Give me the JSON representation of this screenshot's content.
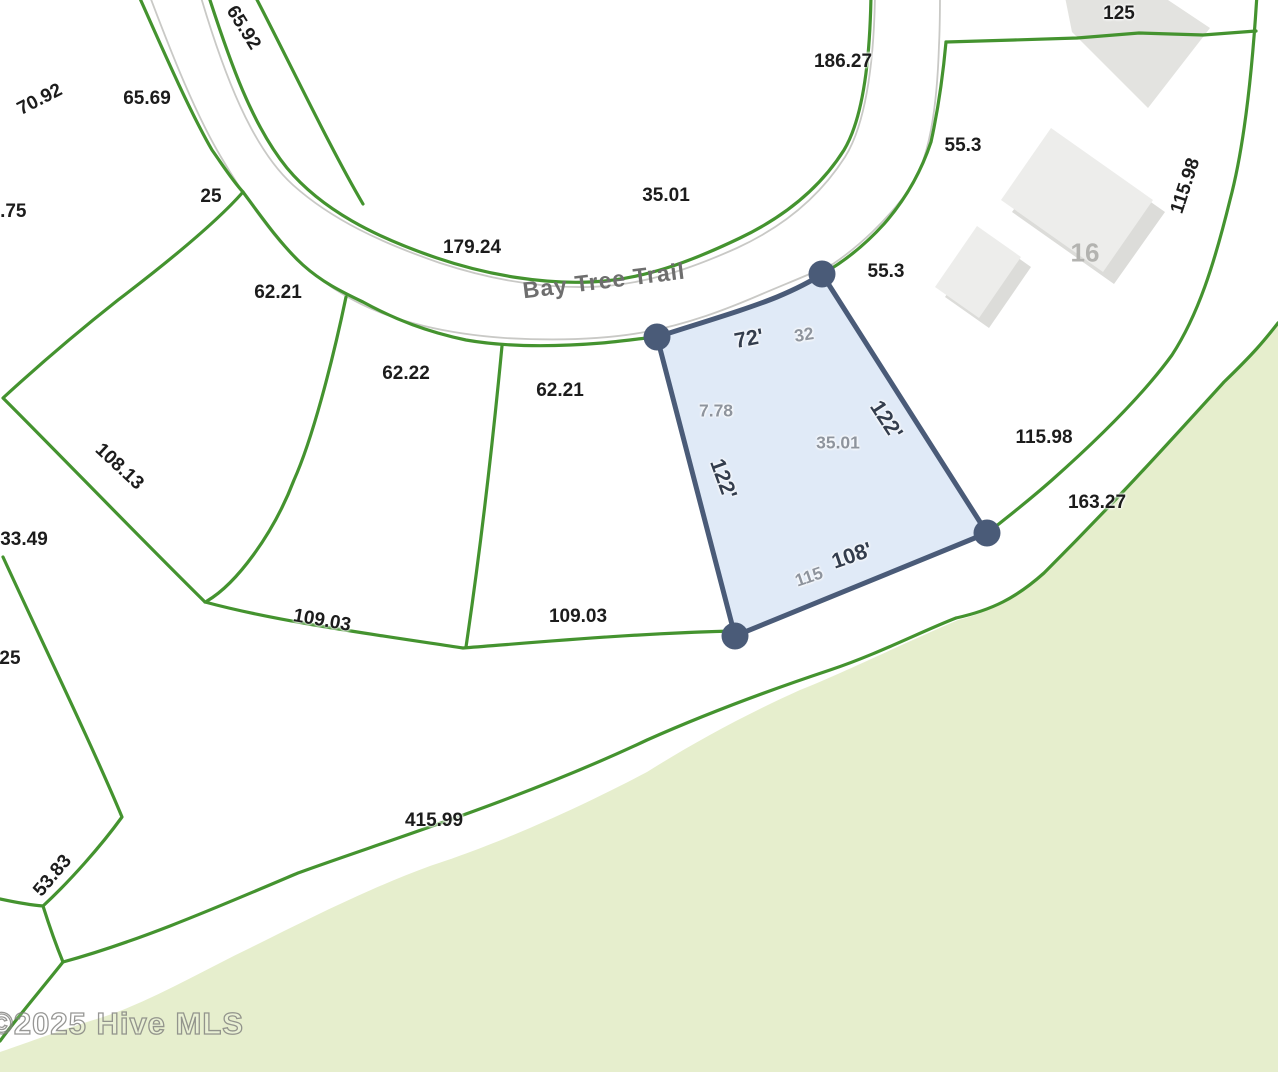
{
  "map": {
    "street_name": "Bay Tree Trail",
    "watermark": "©2025 Hive MLS",
    "highlighted_lot": {
      "lot_number": "32",
      "frontage": "72'",
      "left_side": "122'",
      "right_side": "122'",
      "rear": "108'",
      "gray_values": [
        "7.78",
        "35.01",
        "115"
      ]
    },
    "building_parcel_number": "16",
    "colors": {
      "parcel_line_green": "#44932f",
      "road_casing_gray": "#c9c9c6",
      "conservation_green": "#e6eecd",
      "lot_fill_blue": "#d9e5f5",
      "lot_border_slate": "#4a5b78",
      "building_gray": "#ececea"
    },
    "labels": [
      {
        "text": "65.92",
        "x": 243,
        "y": 28,
        "rot": 58,
        "kind": "black"
      },
      {
        "text": "70.92",
        "x": 40,
        "y": 100,
        "rot": -27,
        "kind": "black"
      },
      {
        "text": "65.69",
        "x": 147,
        "y": 99,
        "rot": 0,
        "kind": "black"
      },
      {
        "text": "1.75",
        "x": 8,
        "y": 212,
        "rot": 0,
        "kind": "black"
      },
      {
        "text": "25",
        "x": 211,
        "y": 197,
        "rot": 0,
        "kind": "black"
      },
      {
        "text": "186.27",
        "x": 843,
        "y": 62,
        "rot": 0,
        "kind": "black"
      },
      {
        "text": "125",
        "x": 1119,
        "y": 14,
        "rot": 0,
        "kind": "black"
      },
      {
        "text": "55.3",
        "x": 963,
        "y": 146,
        "rot": 0,
        "kind": "black"
      },
      {
        "text": "115.98",
        "x": 1186,
        "y": 186,
        "rot": -72,
        "kind": "black"
      },
      {
        "text": "35.01",
        "x": 666,
        "y": 196,
        "rot": 0,
        "kind": "black"
      },
      {
        "text": "179.24",
        "x": 472,
        "y": 248,
        "rot": 0,
        "kind": "black"
      },
      {
        "text": "55.3",
        "x": 886,
        "y": 272,
        "rot": 0,
        "kind": "black"
      },
      {
        "text": "62.21",
        "x": 278,
        "y": 293,
        "rot": 0,
        "kind": "black"
      },
      {
        "text": "62.22",
        "x": 406,
        "y": 374,
        "rot": 0,
        "kind": "black"
      },
      {
        "text": "62.21",
        "x": 560,
        "y": 391,
        "rot": 0,
        "kind": "black"
      },
      {
        "text": "108.13",
        "x": 119,
        "y": 467,
        "rot": 43,
        "kind": "black"
      },
      {
        "text": "33.49",
        "x": 24,
        "y": 540,
        "rot": 0,
        "kind": "black"
      },
      {
        "text": "109.03",
        "x": 322,
        "y": 621,
        "rot": 10,
        "kind": "black"
      },
      {
        "text": "109.03",
        "x": 578,
        "y": 617,
        "rot": 0,
        "kind": "black"
      },
      {
        "text": "25",
        "x": 10,
        "y": 659,
        "rot": 0,
        "kind": "black"
      },
      {
        "text": "115.98",
        "x": 1044,
        "y": 438,
        "rot": 0,
        "kind": "black"
      },
      {
        "text": "163.27",
        "x": 1097,
        "y": 503,
        "rot": 0,
        "kind": "black"
      },
      {
        "text": "415.99",
        "x": 434,
        "y": 821,
        "rot": 0,
        "kind": "black"
      },
      {
        "text": "53.83",
        "x": 53,
        "y": 876,
        "rot": -50,
        "kind": "black"
      },
      {
        "text": "16",
        "x": 1085,
        "y": 253,
        "rot": 0,
        "kind": "bldg"
      },
      {
        "text": "Bay Tree Trail",
        "x": 604,
        "y": 281,
        "rot": -7,
        "kind": "street"
      },
      {
        "text": "©2025 Hive MLS",
        "x": 117,
        "y": 1024,
        "rot": 0,
        "kind": "watermark"
      },
      {
        "text": "72'",
        "x": 749,
        "y": 339,
        "rot": -11,
        "kind": "hl"
      },
      {
        "text": "32",
        "x": 804,
        "y": 335,
        "rot": -9,
        "kind": "gray"
      },
      {
        "text": "7.78",
        "x": 716,
        "y": 411,
        "rot": 0,
        "kind": "gray"
      },
      {
        "text": "35.01",
        "x": 838,
        "y": 443,
        "rot": 0,
        "kind": "gray"
      },
      {
        "text": "122'",
        "x": 886,
        "y": 420,
        "rot": 57,
        "kind": "hl"
      },
      {
        "text": "122'",
        "x": 723,
        "y": 479,
        "rot": 70,
        "kind": "hl"
      },
      {
        "text": "115",
        "x": 809,
        "y": 577,
        "rot": -19,
        "kind": "gray"
      },
      {
        "text": "108'",
        "x": 852,
        "y": 556,
        "rot": -19,
        "kind": "hl"
      }
    ]
  }
}
